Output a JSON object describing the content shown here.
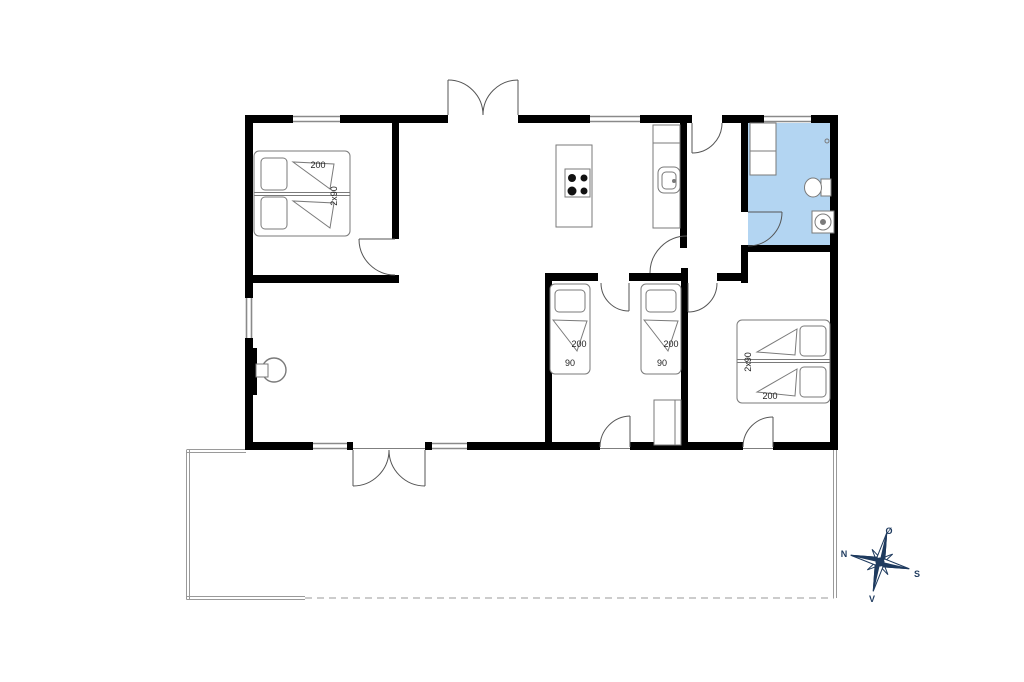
{
  "beds": [
    {
      "name": "double-bed-northwest",
      "length": "200",
      "width": "2x90"
    },
    {
      "name": "single-bed-west",
      "length": "200",
      "width": "90"
    },
    {
      "name": "single-bed-east",
      "length": "200",
      "width": "90"
    },
    {
      "name": "double-bed-southeast",
      "length": "200",
      "width": "2x90"
    }
  ],
  "compass": {
    "north": "N",
    "south": "S",
    "east": "Ø",
    "west": "V"
  },
  "colors": {
    "wall": "#000000",
    "bathroom": "#b3d5f2",
    "window": "#8a8a8a",
    "door_arc": "#555555",
    "furniture": "#7a7a7a",
    "burner": "#111111",
    "label": "#222222",
    "terrace": "#9a9a9a",
    "compass": "#1e3a5e"
  }
}
